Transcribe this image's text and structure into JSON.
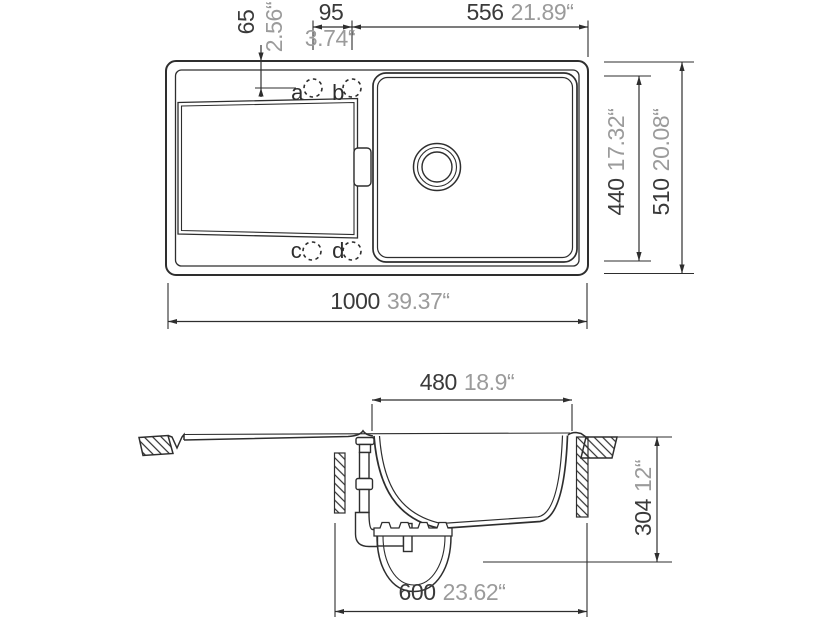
{
  "figure": {
    "type": "technical-drawing",
    "subject": "kitchen sink with drainboard, top view and section view",
    "line_color": "#2e2e2e",
    "mm_text_color": "#3a3a3a",
    "inch_text_color": "#9b9b9b",
    "background": "#ffffff"
  },
  "top_view": {
    "dim_65": {
      "mm": "65",
      "inch": "2.56“"
    },
    "dim_95": {
      "mm": "95",
      "inch": "3.74“"
    },
    "dim_556": {
      "mm": "556",
      "inch": "21.89“"
    },
    "dim_440": {
      "mm": "440",
      "inch": "17.32“"
    },
    "dim_510": {
      "mm": "510",
      "inch": "20.08“"
    },
    "dim_1000": {
      "mm": "1000",
      "inch": "39.37“"
    },
    "hole_labels": {
      "a": "a",
      "b": "b",
      "c": "c",
      "d": "d"
    }
  },
  "side_view": {
    "dim_480": {
      "mm": "480",
      "inch": "18.9“"
    },
    "dim_600": {
      "mm": "600",
      "inch": "23.62“"
    },
    "dim_304": {
      "mm": "304",
      "inch": "12“"
    }
  }
}
